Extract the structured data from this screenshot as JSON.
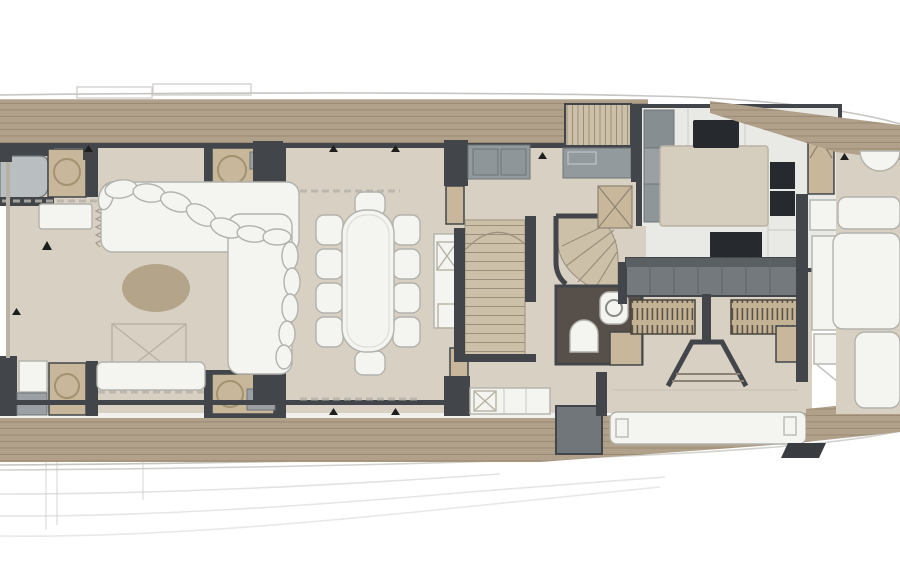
{
  "title": "Motor yacht main deck floor plan",
  "plan": {
    "view": "top-down naval architecture deck plan, bow oriented to the right",
    "rooms": [
      "aft-deck",
      "salon-lounge",
      "dining-area",
      "foyer",
      "staircase-down",
      "staircase-up-spiral",
      "flybridge-stairs",
      "day-head",
      "galley",
      "helm-station",
      "port-side-deck",
      "starboard-side-deck",
      "foredeck"
    ],
    "furniture": [
      "l-shaped-sofa",
      "oval-rug",
      "side-table",
      "hi-lo-table-with-x-mark",
      "bench-seat",
      "dining-table-ten-chairs",
      "aft-bar-cabinets-with-sinks",
      "tv-lift-cabinet",
      "dumbwaiter",
      "galley-island",
      "cooktop",
      "galley-sinks",
      "fridge-locker",
      "toilet",
      "washbasin",
      "helm-console",
      "helm-seats",
      "companionway-steps",
      "side-door-panels",
      "sun-pads",
      "tender-pad",
      "half-round-seat",
      "cleat"
    ]
  },
  "colors": {
    "hull_line": "#c6c5c1",
    "deck_wood": "#b1a18b",
    "deck_wood_line": "#9c8c75",
    "floor_beige": "#d8d0c2",
    "floor_light": "#e9e9e6",
    "wall_dark": "#42464a",
    "counter_gray": "#939a9e",
    "console_gray": "#74797d",
    "appliance_dark": "#26292d",
    "cabinet_tan": "#c8b79b",
    "stair_tread": "#cdc0a9",
    "stair_line": "#9a8f7c",
    "furniture_white": "#f4f4f1",
    "furniture_stroke": "#b2b2ad",
    "rug_tan": "#b4a58a",
    "head_floor": "#57504a",
    "seat_hatch_tan": "#c3b294",
    "seat_hatch_line": "#5b5348",
    "marker_dark": "#1e1e1e"
  }
}
